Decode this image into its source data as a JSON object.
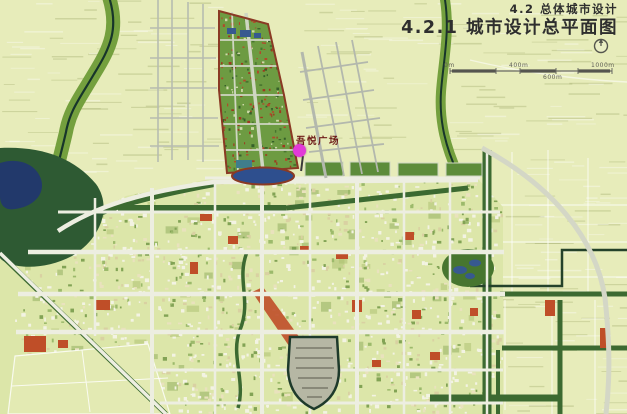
{
  "header": {
    "section_label": "4.2 总体城市设计",
    "page_title": "4.2.1 城市设计总平面图"
  },
  "map": {
    "plaza_label": "吾悦广场",
    "scale_bar_labels": [
      "0m",
      "400m",
      "600m",
      "1000m"
    ],
    "icons": [
      "north-arrow-icon"
    ]
  },
  "colors": {
    "farm": "#e7ecba",
    "urban": "#dce6a9",
    "district": "#6d9b42",
    "tree": "#3c6a31",
    "forest": "#2e5a33",
    "riverband": "#74a03e",
    "riverline": "#17352a",
    "lake": "#22396b",
    "water": "#37598f",
    "road": "#edeee1",
    "red": "#bf4e28",
    "outline": "#8a3a24",
    "marker": "#e23ad8",
    "title_text": "#2e2e2e",
    "label_text": "#6e1b17"
  }
}
